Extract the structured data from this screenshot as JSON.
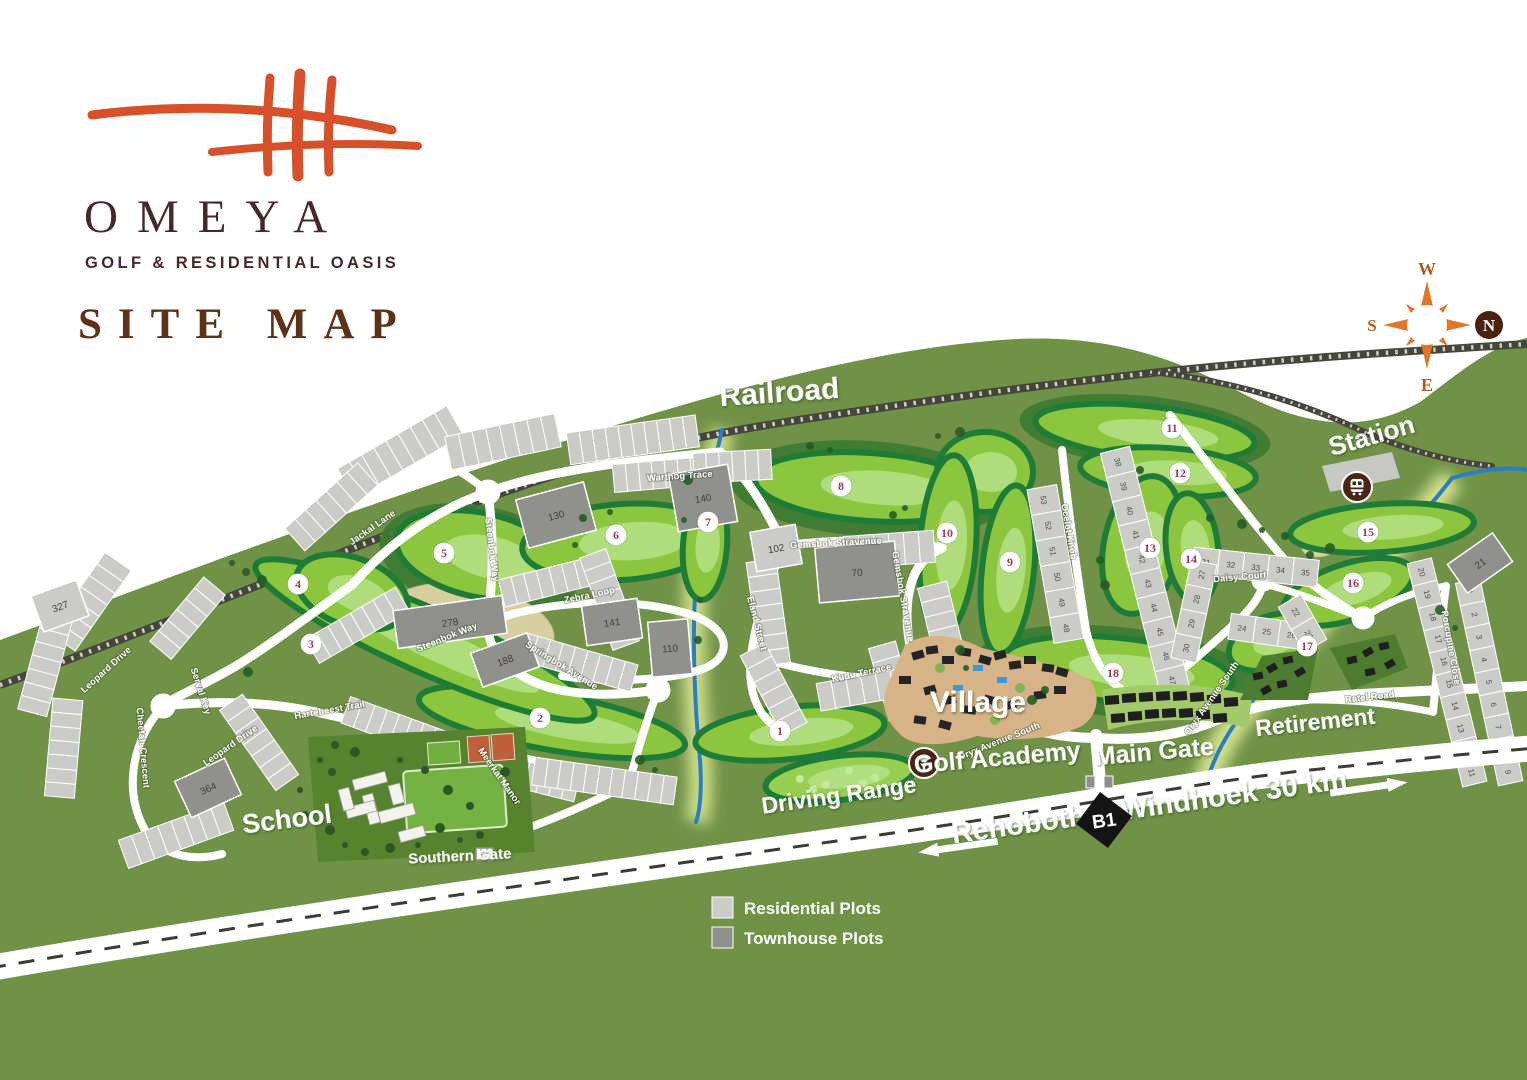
{
  "logo": {
    "brand": "OMEYA",
    "tagline": "GOLF & RESIDENTIAL OASIS",
    "page_title": "SITE MAP"
  },
  "compass": {
    "north": "N",
    "south": "S",
    "east": "E",
    "west": "W"
  },
  "legend": {
    "residential_label": "Residential Plots",
    "townhouse_label": "Townhouse Plots"
  },
  "highway": {
    "badge": "B1",
    "west_label": "Rehoboth",
    "east_label": "Windhoek 30 km"
  },
  "colors": {
    "accent_orange": "#d7502a",
    "brand_brown": "#44282a",
    "heading_brown": "#5c3318",
    "hill_green": "#6f9247",
    "fairway_green": "#8cc63e",
    "fairway_light": "#b6e087",
    "fairway_dark": "#1e7c37",
    "rough_green": "#3c7a33",
    "sand_tan": "#d7cfa0",
    "residential_gray": "#cbccc8",
    "townhouse_gray": "#90918d",
    "river_blue": "#2b7fc0",
    "glow_yellow": "#eef7a0",
    "road_white": "#ffffff",
    "rail_dark": "#45453b",
    "hole_number": "#a23a56",
    "icon_brown": "#4a2414",
    "village_tan": "#d7b488"
  },
  "map_labels": [
    {
      "text": "Railroad",
      "x": 780,
      "y": 402,
      "rot": -4,
      "size": 30
    },
    {
      "text": "Station",
      "x": 1374,
      "y": 444,
      "rot": -16,
      "size": 26
    },
    {
      "text": "Village",
      "x": 978,
      "y": 712,
      "rot": 0,
      "size": 30
    },
    {
      "text": "Golf Academy",
      "x": 998,
      "y": 766,
      "rot": -5,
      "size": 25
    },
    {
      "text": "Driving Range",
      "x": 840,
      "y": 803,
      "rot": -8,
      "size": 23
    },
    {
      "text": "Main Gate",
      "x": 1155,
      "y": 760,
      "rot": -5,
      "size": 25
    },
    {
      "text": "Southern Gate",
      "x": 460,
      "y": 861,
      "rot": -3,
      "size": 15
    },
    {
      "text": "School",
      "x": 288,
      "y": 828,
      "rot": -7,
      "size": 27
    },
    {
      "text": "Retirement",
      "x": 1316,
      "y": 730,
      "rot": -6,
      "size": 23
    },
    {
      "text": "Rehoboth",
      "x": 1020,
      "y": 834,
      "rot": -8,
      "size": 29
    },
    {
      "text": "Windhoek 30 km",
      "x": 1235,
      "y": 804,
      "rot": -8,
      "size": 29
    }
  ],
  "street_labels": [
    {
      "name": "Warthog Trace",
      "x": 680,
      "y": 479,
      "rot": -4
    },
    {
      "name": "Jackal Lane",
      "x": 374,
      "y": 530,
      "rot": -35
    },
    {
      "name": "Steenbok Way",
      "x": 489,
      "y": 550,
      "rot": 83
    },
    {
      "name": "Zebra Loop",
      "x": 590,
      "y": 598,
      "rot": -12
    },
    {
      "name": "Steenbok Way",
      "x": 448,
      "y": 640,
      "rot": -22
    },
    {
      "name": "Springbok Avenue",
      "x": 560,
      "y": 668,
      "rot": 32
    },
    {
      "name": "Hartebeest Trail",
      "x": 330,
      "y": 713,
      "rot": -10
    },
    {
      "name": "Meerkat Manor",
      "x": 497,
      "y": 778,
      "rot": 55
    },
    {
      "name": "Leopard Drive",
      "x": 108,
      "y": 672,
      "rot": -42
    },
    {
      "name": "Serval Key",
      "x": 198,
      "y": 692,
      "rot": 72
    },
    {
      "name": "Cheetah Crescent",
      "x": 140,
      "y": 748,
      "rot": 85
    },
    {
      "name": "Leopard Drive",
      "x": 232,
      "y": 748,
      "rot": -35
    },
    {
      "name": "Gemsbok Stravenue",
      "x": 836,
      "y": 546,
      "rot": -3
    },
    {
      "name": "Gemsbok Stravenue",
      "x": 900,
      "y": 597,
      "rot": 80
    },
    {
      "name": "Eland Street",
      "x": 754,
      "y": 624,
      "rot": 75
    },
    {
      "name": "Kudu Terrace",
      "x": 862,
      "y": 676,
      "rot": -12
    },
    {
      "name": "Oryx Avenue South",
      "x": 1000,
      "y": 744,
      "rot": -22
    },
    {
      "name": "Oryx Avenue South",
      "x": 1214,
      "y": 700,
      "rot": -55
    },
    {
      "name": "Ocelot Knob",
      "x": 1066,
      "y": 532,
      "rot": 80
    },
    {
      "name": "Daisy Court",
      "x": 1240,
      "y": 580,
      "rot": -5
    },
    {
      "name": "Porcupine Close",
      "x": 1448,
      "y": 648,
      "rot": 80
    },
    {
      "name": "Ratel Road",
      "x": 1370,
      "y": 700,
      "rot": -6
    }
  ],
  "holes": [
    {
      "n": "1",
      "x": 780,
      "y": 731
    },
    {
      "n": "2",
      "x": 540,
      "y": 718
    },
    {
      "n": "3",
      "x": 311,
      "y": 644
    },
    {
      "n": "4",
      "x": 298,
      "y": 584
    },
    {
      "n": "5",
      "x": 444,
      "y": 553
    },
    {
      "n": "6",
      "x": 616,
      "y": 535
    },
    {
      "n": "7",
      "x": 708,
      "y": 522
    },
    {
      "n": "8",
      "x": 841,
      "y": 486
    },
    {
      "n": "9",
      "x": 1010,
      "y": 562
    },
    {
      "n": "10",
      "x": 947,
      "y": 533
    },
    {
      "n": "11",
      "x": 1172,
      "y": 428
    },
    {
      "n": "12",
      "x": 1180,
      "y": 473
    },
    {
      "n": "13",
      "x": 1150,
      "y": 548
    },
    {
      "n": "14",
      "x": 1191,
      "y": 559
    },
    {
      "n": "15",
      "x": 1368,
      "y": 532
    },
    {
      "n": "16",
      "x": 1353,
      "y": 583
    },
    {
      "n": "17",
      "x": 1307,
      "y": 646
    },
    {
      "n": "18",
      "x": 1113,
      "y": 673
    }
  ],
  "fairways": [
    {
      "x": 790,
      "y": 733,
      "rx": 95,
      "ry": 26,
      "rot": -6
    },
    {
      "x": 552,
      "y": 722,
      "rx": 135,
      "ry": 28,
      "rot": 10
    },
    {
      "x": 425,
      "y": 640,
      "rx": 185,
      "ry": 32,
      "rot": 24
    },
    {
      "x": 352,
      "y": 592,
      "rx": 58,
      "ry": 34,
      "rot": 20
    },
    {
      "x": 480,
      "y": 555,
      "rx": 85,
      "ry": 42,
      "rot": 12
    },
    {
      "x": 622,
      "y": 542,
      "rx": 100,
      "ry": 38,
      "rot": -4
    },
    {
      "x": 705,
      "y": 545,
      "rx": 22,
      "ry": 55,
      "rot": 4
    },
    {
      "x": 870,
      "y": 487,
      "rx": 115,
      "ry": 34,
      "rot": 4
    },
    {
      "x": 985,
      "y": 472,
      "rx": 48,
      "ry": 40,
      "rot": 0
    },
    {
      "x": 1008,
      "y": 570,
      "rx": 26,
      "ry": 85,
      "rot": 6
    },
    {
      "x": 948,
      "y": 545,
      "rx": 28,
      "ry": 90,
      "rot": 4
    },
    {
      "x": 1145,
      "y": 432,
      "rx": 110,
      "ry": 26,
      "rot": 6
    },
    {
      "x": 1168,
      "y": 472,
      "rx": 88,
      "ry": 24,
      "rot": 4
    },
    {
      "x": 1142,
      "y": 545,
      "rx": 38,
      "ry": 70,
      "rot": 12
    },
    {
      "x": 1192,
      "y": 548,
      "rx": 26,
      "ry": 55,
      "rot": -6
    },
    {
      "x": 1382,
      "y": 528,
      "rx": 92,
      "ry": 24,
      "rot": -4
    },
    {
      "x": 1348,
      "y": 592,
      "rx": 68,
      "ry": 28,
      "rot": -18
    },
    {
      "x": 1272,
      "y": 642,
      "rx": 45,
      "ry": 26,
      "rot": -20
    },
    {
      "x": 1118,
      "y": 670,
      "rx": 115,
      "ry": 32,
      "rot": 6
    },
    {
      "x": 840,
      "y": 778,
      "rx": 75,
      "ry": 22,
      "rot": -7,
      "light": true
    }
  ],
  "roughs": [
    {
      "x": 870,
      "y": 489,
      "rx": 140,
      "ry": 48,
      "rot": 4
    },
    {
      "x": 1118,
      "y": 672,
      "rx": 142,
      "ry": 45,
      "rot": 6
    },
    {
      "x": 1145,
      "y": 432,
      "rx": 126,
      "ry": 36,
      "rot": 6
    },
    {
      "x": 480,
      "y": 560,
      "rx": 102,
      "ry": 54,
      "rot": 12
    }
  ],
  "sands": [
    {
      "x": 470,
      "y": 625,
      "rx": 85,
      "ry": 40,
      "rot": 10
    },
    {
      "x": 640,
      "y": 535,
      "rx": 35,
      "ry": 16,
      "rot": -5
    },
    {
      "x": 1160,
      "y": 540,
      "rx": 24,
      "ry": 14,
      "rot": 0
    },
    {
      "x": 1010,
      "y": 470,
      "rx": 22,
      "ry": 12,
      "rot": 0
    },
    {
      "x": 1318,
      "y": 548,
      "rx": 16,
      "ry": 9,
      "rot": 0
    }
  ],
  "townhouse_blocks": [
    {
      "label": "130",
      "x": 556,
      "y": 515,
      "w": 70,
      "h": 50,
      "rot": -15,
      "dark": true
    },
    {
      "label": "140",
      "x": 703,
      "y": 498,
      "w": 60,
      "h": 58,
      "rot": -10,
      "dark": true
    },
    {
      "label": "141",
      "x": 612,
      "y": 622,
      "w": 56,
      "h": 40,
      "rot": -8,
      "dark": true
    },
    {
      "label": "110",
      "x": 670,
      "y": 648,
      "w": 40,
      "h": 55,
      "rot": -5,
      "dark": true
    },
    {
      "label": "278",
      "x": 450,
      "y": 622,
      "w": 110,
      "h": 38,
      "rot": -8,
      "dark": true
    },
    {
      "label": "188",
      "x": 505,
      "y": 660,
      "w": 60,
      "h": 36,
      "rot": -20,
      "dark": true
    },
    {
      "label": "70",
      "x": 857,
      "y": 572,
      "w": 80,
      "h": 55,
      "rot": -5,
      "dark": true
    },
    {
      "label": "21",
      "x": 1480,
      "y": 563,
      "w": 55,
      "h": 35,
      "rot": -35,
      "dark": true
    },
    {
      "label": "364",
      "x": 208,
      "y": 788,
      "w": 55,
      "h": 40,
      "rot": -25,
      "dark": true
    },
    {
      "label": "102",
      "x": 776,
      "y": 548,
      "w": 46,
      "h": 40,
      "rot": -10,
      "dark": false
    },
    {
      "label": "327",
      "x": 60,
      "y": 606,
      "w": 48,
      "h": 38,
      "rot": -20,
      "dark": false
    }
  ],
  "parcel_strips": [
    {
      "x": 352,
      "y": 480,
      "rot": -30,
      "n": 9,
      "w": 14,
      "h": 34
    },
    {
      "x": 455,
      "y": 452,
      "rot": -12,
      "n": 8,
      "w": 14,
      "h": 34
    },
    {
      "x": 575,
      "y": 448,
      "rot": -8,
      "n": 10,
      "w": 13,
      "h": 32
    },
    {
      "x": 620,
      "y": 478,
      "rot": -5,
      "n": 9,
      "w": 13,
      "h": 28
    },
    {
      "x": 700,
      "y": 468,
      "rot": -3,
      "n": 6,
      "w": 13,
      "h": 30
    },
    {
      "x": 300,
      "y": 535,
      "rot": -42,
      "n": 7,
      "w": 14,
      "h": 30
    },
    {
      "x": 66,
      "y": 636,
      "rot": -55,
      "n": 7,
      "w": 14,
      "h": 32
    },
    {
      "x": 34,
      "y": 706,
      "rot": -75,
      "n": 8,
      "w": 14,
      "h": 30
    },
    {
      "x": 60,
      "y": 790,
      "rot": -85,
      "n": 7,
      "w": 14,
      "h": 30
    },
    {
      "x": 130,
      "y": 852,
      "rot": -20,
      "n": 8,
      "w": 14,
      "h": 30
    },
    {
      "x": 165,
      "y": 645,
      "rot": -50,
      "n": 6,
      "w": 14,
      "h": 28
    },
    {
      "x": 235,
      "y": 708,
      "rot": 55,
      "n": 7,
      "w": 14,
      "h": 28
    },
    {
      "x": 318,
      "y": 648,
      "rot": -30,
      "n": 8,
      "w": 13,
      "h": 28
    },
    {
      "x": 352,
      "y": 712,
      "rot": 20,
      "n": 10,
      "w": 13,
      "h": 28
    },
    {
      "x": 432,
      "y": 752,
      "rot": 14,
      "n": 12,
      "w": 13,
      "h": 28
    },
    {
      "x": 540,
      "y": 772,
      "rot": 8,
      "n": 11,
      "w": 13,
      "h": 28
    },
    {
      "x": 508,
      "y": 592,
      "rot": -14,
      "n": 8,
      "w": 13,
      "h": 28
    },
    {
      "x": 528,
      "y": 648,
      "rot": 16,
      "n": 9,
      "w": 13,
      "h": 28
    },
    {
      "x": 595,
      "y": 560,
      "rot": 70,
      "n": 7,
      "w": 14,
      "h": 28
    },
    {
      "x": 762,
      "y": 568,
      "rot": 82,
      "n": 7,
      "w": 15,
      "h": 30
    },
    {
      "x": 852,
      "y": 552,
      "rot": -4,
      "n": 6,
      "w": 15,
      "h": 32
    },
    {
      "x": 934,
      "y": 592,
      "rot": 76,
      "n": 6,
      "w": 15,
      "h": 30
    },
    {
      "x": 884,
      "y": 652,
      "rot": 74,
      "n": 5,
      "w": 15,
      "h": 28
    },
    {
      "x": 826,
      "y": 696,
      "rot": -10,
      "n": 7,
      "w": 15,
      "h": 28
    },
    {
      "x": 756,
      "y": 656,
      "rot": 62,
      "n": 6,
      "w": 15,
      "h": 28
    },
    {
      "x": 1118,
      "y": 462,
      "rot": 76,
      "n": 10,
      "w": 25,
      "h": 30,
      "start": 38
    },
    {
      "x": 1044,
      "y": 500,
      "rot": 80,
      "n": 6,
      "w": 26,
      "h": 30,
      "start": 53,
      "dir": -1
    },
    {
      "x": 1206,
      "y": 562,
      "rot": 6,
      "n": 5,
      "w": 25,
      "h": 27,
      "start": 31
    },
    {
      "x": 1186,
      "y": 648,
      "rot": -78,
      "n": 4,
      "w": 25,
      "h": 26,
      "start": 30,
      "dir": -1
    },
    {
      "x": 1242,
      "y": 628,
      "rot": 8,
      "n": 3,
      "w": 25,
      "h": 26,
      "start": 24
    },
    {
      "x": 1296,
      "y": 612,
      "rot": 60,
      "n": 2,
      "w": 26,
      "h": 26,
      "start": 22
    },
    {
      "x": 1470,
      "y": 592,
      "rot": 78,
      "n": 9,
      "w": 23,
      "h": 25,
      "start": 1
    },
    {
      "x": 1422,
      "y": 572,
      "rot": 76,
      "n": 10,
      "w": 23,
      "h": 25,
      "start": 20,
      "dir": -1
    }
  ]
}
